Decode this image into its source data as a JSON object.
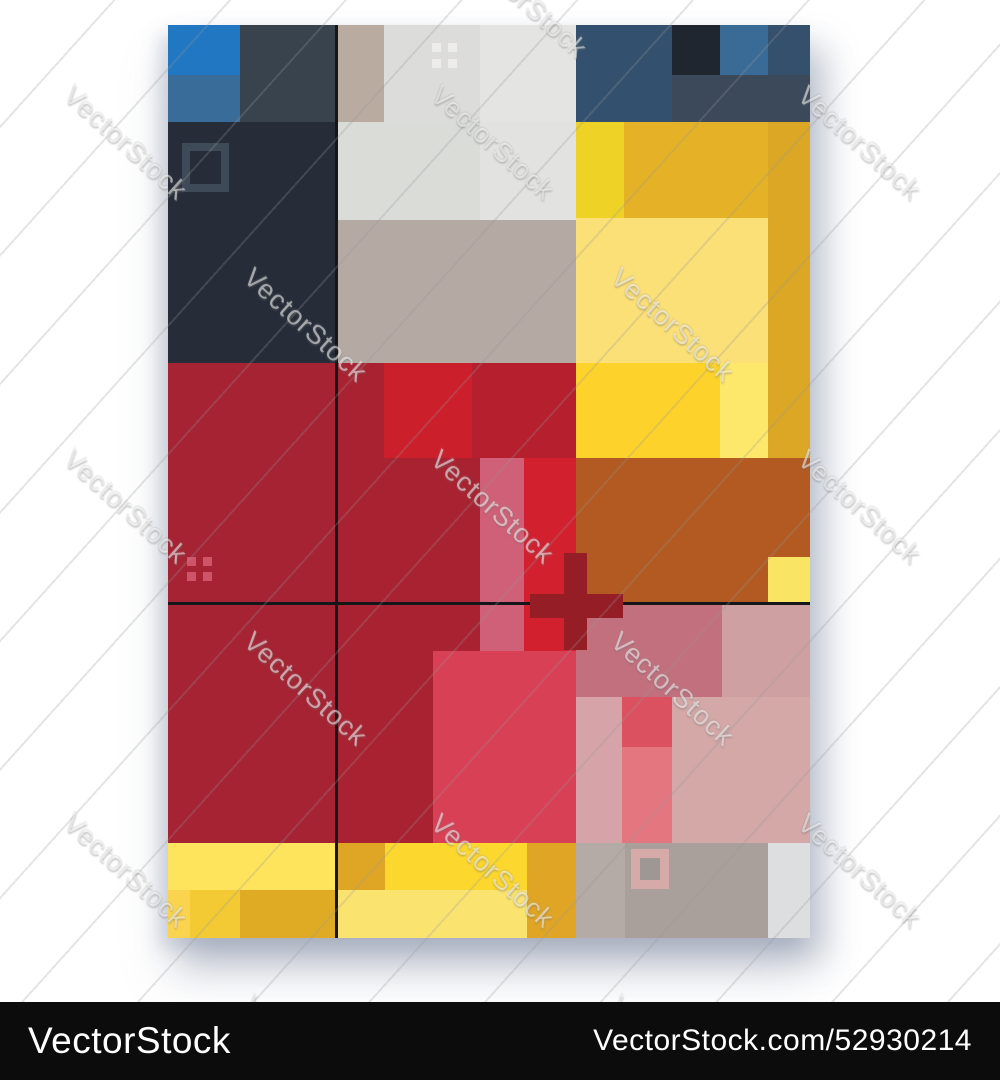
{
  "watermark": {
    "text": "VectorStock",
    "angle_deg": 42,
    "tiles": [
      {
        "x": 478,
        "y": -62
      },
      {
        "x": 78,
        "y": 80
      },
      {
        "x": 445,
        "y": 80
      },
      {
        "x": 812,
        "y": 80
      },
      {
        "x": 258,
        "y": 262
      },
      {
        "x": 625,
        "y": 262
      },
      {
        "x": 78,
        "y": 444
      },
      {
        "x": 445,
        "y": 444
      },
      {
        "x": 812,
        "y": 444
      },
      {
        "x": 258,
        "y": 626
      },
      {
        "x": 625,
        "y": 626
      },
      {
        "x": 78,
        "y": 808
      },
      {
        "x": 445,
        "y": 808
      },
      {
        "x": 812,
        "y": 808
      },
      {
        "x": 258,
        "y": 990
      },
      {
        "x": 625,
        "y": 990
      }
    ]
  },
  "footer": {
    "left_text": "VectorStock",
    "right_text": "VectorStock.com/52930214",
    "background": "#0c0c0c",
    "text_color": "#ffffff"
  },
  "poster": {
    "x": 168,
    "y": 25,
    "w": 642,
    "h": 913,
    "blocks": [
      {
        "name": "top-left-slate",
        "x": 0,
        "y": 0,
        "w": 168,
        "h": 97,
        "color": "#39434e"
      },
      {
        "name": "top-left-blue-bright",
        "x": 0,
        "y": 0,
        "w": 72,
        "h": 50,
        "color": "#2277c2"
      },
      {
        "name": "top-left-blue-medium",
        "x": 0,
        "y": 50,
        "w": 72,
        "h": 47,
        "color": "#3a6c99"
      },
      {
        "name": "top-left-navy-dark",
        "x": 0,
        "y": 97,
        "w": 168,
        "h": 241,
        "color": "#262d39"
      },
      {
        "name": "square-frame-dark",
        "x": 14,
        "y": 118,
        "w": 47,
        "h": 49,
        "border_color": "#3f4a58",
        "border_width": 8
      },
      {
        "name": "top-mid-taupe",
        "x": 168,
        "y": 0,
        "w": 48,
        "h": 97,
        "color": "#b9ab9f"
      },
      {
        "name": "top-mid-gray-1",
        "x": 216,
        "y": 0,
        "w": 96,
        "h": 97,
        "color": "#dcdcda"
      },
      {
        "name": "top-mid-gray-2",
        "x": 312,
        "y": 0,
        "w": 96,
        "h": 97,
        "color": "#e4e4e3"
      },
      {
        "name": "top-mid-sage",
        "x": 168,
        "y": 97,
        "w": 144,
        "h": 98,
        "color": "#d9dcd7"
      },
      {
        "name": "top-mid-gray-3",
        "x": 312,
        "y": 97,
        "w": 96,
        "h": 98,
        "color": "#e2e2e1"
      },
      {
        "name": "top-mid-taupe-row",
        "x": 168,
        "y": 195,
        "w": 240,
        "h": 143,
        "color": "#b5a9a3"
      },
      {
        "name": "white-dot",
        "x": 264,
        "y": 18,
        "w": 9,
        "h": 9,
        "color": "#efedeb"
      },
      {
        "name": "white-dot",
        "x": 280,
        "y": 18,
        "w": 9,
        "h": 9,
        "color": "#efedeb"
      },
      {
        "name": "white-dot",
        "x": 264,
        "y": 34,
        "w": 9,
        "h": 9,
        "color": "#efedeb"
      },
      {
        "name": "white-dot",
        "x": 280,
        "y": 34,
        "w": 9,
        "h": 9,
        "color": "#efedeb"
      },
      {
        "name": "top-right-navy",
        "x": 408,
        "y": 0,
        "w": 234,
        "h": 97,
        "color": "#33516e"
      },
      {
        "name": "top-right-dark-square",
        "x": 504,
        "y": 0,
        "w": 48,
        "h": 50,
        "color": "#20262f"
      },
      {
        "name": "top-right-blue-square",
        "x": 552,
        "y": 0,
        "w": 48,
        "h": 50,
        "color": "#3a6b97"
      },
      {
        "name": "top-right-navy-corner",
        "x": 600,
        "y": 0,
        "w": 42,
        "h": 50,
        "color": "#35506d"
      },
      {
        "name": "top-right-slate-strip",
        "x": 504,
        "y": 50,
        "w": 138,
        "h": 47,
        "color": "#3b495b"
      },
      {
        "name": "tr-yellow-bright",
        "x": 408,
        "y": 97,
        "w": 48,
        "h": 96,
        "color": "#eed225"
      },
      {
        "name": "tr-amber",
        "x": 456,
        "y": 97,
        "w": 144,
        "h": 96,
        "color": "#e5b126"
      },
      {
        "name": "tr-amber-column",
        "x": 600,
        "y": 97,
        "w": 42,
        "h": 336,
        "color": "#dba724"
      },
      {
        "name": "tr-yellow-light",
        "x": 408,
        "y": 193,
        "w": 192,
        "h": 145,
        "color": "#fbdf77"
      },
      {
        "name": "tr-yellow-bright-2",
        "x": 408,
        "y": 338,
        "w": 144,
        "h": 95,
        "color": "#fcd22b"
      },
      {
        "name": "tr-yellow-pale",
        "x": 552,
        "y": 338,
        "w": 48,
        "h": 95,
        "color": "#fde86b"
      },
      {
        "name": "mid-left-red",
        "x": 0,
        "y": 338,
        "w": 168,
        "h": 239,
        "color": "#a52333"
      },
      {
        "name": "bottom-left-red",
        "x": 0,
        "y": 577,
        "w": 168,
        "h": 241,
        "color": "#a52333"
      },
      {
        "name": "mid-red-base",
        "x": 168,
        "y": 338,
        "w": 240,
        "h": 239,
        "color": "#a92231"
      },
      {
        "name": "bottom-mid-red",
        "x": 168,
        "y": 577,
        "w": 240,
        "h": 241,
        "color": "#a92231"
      },
      {
        "name": "red-dot",
        "x": 19,
        "y": 532,
        "w": 9,
        "h": 9,
        "color": "#d05468"
      },
      {
        "name": "red-dot",
        "x": 35,
        "y": 532,
        "w": 9,
        "h": 9,
        "color": "#d05468"
      },
      {
        "name": "red-dot",
        "x": 19,
        "y": 547,
        "w": 9,
        "h": 9,
        "color": "#d05468"
      },
      {
        "name": "red-dot",
        "x": 35,
        "y": 547,
        "w": 9,
        "h": 9,
        "color": "#d05468"
      },
      {
        "name": "mid-red-column",
        "x": 304,
        "y": 338,
        "w": 104,
        "h": 95,
        "color": "#b51f2e"
      },
      {
        "name": "mid-red-square",
        "x": 216,
        "y": 338,
        "w": 88,
        "h": 95,
        "color": "#cc1f2c"
      },
      {
        "name": "orange-block",
        "x": 406,
        "y": 433,
        "w": 236,
        "h": 144,
        "color": "#b25a21"
      },
      {
        "name": "pink-band",
        "x": 312,
        "y": 433,
        "w": 44,
        "h": 193,
        "color": "#cf6077"
      },
      {
        "name": "bright-red-column",
        "x": 356,
        "y": 433,
        "w": 52,
        "h": 193,
        "color": "#d2202f"
      },
      {
        "name": "yellow-square-right",
        "x": 600,
        "y": 532,
        "w": 42,
        "h": 45,
        "color": "#fae464"
      },
      {
        "name": "rose-block",
        "x": 265,
        "y": 626,
        "w": 143,
        "h": 192,
        "color": "#d84055"
      },
      {
        "name": "br-rose",
        "x": 408,
        "y": 577,
        "w": 146,
        "h": 95,
        "color": "#c2707e"
      },
      {
        "name": "br-dusty-light",
        "x": 554,
        "y": 577,
        "w": 88,
        "h": 95,
        "color": "#cfa0a2"
      },
      {
        "name": "br-pink-column",
        "x": 408,
        "y": 672,
        "w": 46,
        "h": 146,
        "color": "#d5a3a8"
      },
      {
        "name": "br-redrose-square",
        "x": 454,
        "y": 672,
        "w": 50,
        "h": 50,
        "color": "#dc5160"
      },
      {
        "name": "br-salmon-column",
        "x": 454,
        "y": 722,
        "w": 50,
        "h": 96,
        "color": "#e4767f"
      },
      {
        "name": "br-dusty-pink",
        "x": 504,
        "y": 672,
        "w": 138,
        "h": 146,
        "color": "#d3a8a7"
      },
      {
        "name": "bl-yellow-strip",
        "x": 0,
        "y": 818,
        "w": 168,
        "h": 47,
        "color": "#fde45c"
      },
      {
        "name": "bl-yellow-1",
        "x": 0,
        "y": 865,
        "w": 22,
        "h": 48,
        "color": "#fbd44f"
      },
      {
        "name": "bl-yellow-2",
        "x": 22,
        "y": 865,
        "w": 50,
        "h": 48,
        "color": "#f3ca33"
      },
      {
        "name": "bl-amber",
        "x": 72,
        "y": 865,
        "w": 96,
        "h": 48,
        "color": "#e0ab24"
      },
      {
        "name": "bm-amber-square",
        "x": 168,
        "y": 818,
        "w": 49,
        "h": 47,
        "color": "#dfa626"
      },
      {
        "name": "bm-yellow-bright",
        "x": 217,
        "y": 818,
        "w": 142,
        "h": 47,
        "color": "#fcd72e"
      },
      {
        "name": "bm-amber-column",
        "x": 359,
        "y": 818,
        "w": 49,
        "h": 95,
        "color": "#e0a524"
      },
      {
        "name": "bm-yellow-light",
        "x": 168,
        "y": 865,
        "w": 191,
        "h": 48,
        "color": "#fbe370"
      },
      {
        "name": "br-gray-1",
        "x": 408,
        "y": 818,
        "w": 49,
        "h": 95,
        "color": "#b4aaa6"
      },
      {
        "name": "br-gray-2",
        "x": 457,
        "y": 818,
        "w": 143,
        "h": 95,
        "color": "#a9a09c"
      },
      {
        "name": "br-gray-light",
        "x": 600,
        "y": 818,
        "w": 42,
        "h": 95,
        "color": "#dcdee0"
      },
      {
        "name": "square-frame-pink",
        "x": 463,
        "y": 824,
        "w": 38,
        "h": 40,
        "border_color": "#d7aaaa",
        "border_width": 9,
        "fill": "#9e9793"
      },
      {
        "name": "grid-line-vertical",
        "x": 167,
        "y": 0,
        "w": 3,
        "h": 913,
        "color": "#15161a"
      },
      {
        "name": "grid-line-horizontal",
        "x": 0,
        "y": 577,
        "w": 642,
        "h": 3,
        "color": "#15161a"
      },
      {
        "name": "cross-horizontal",
        "x": 362,
        "y": 569,
        "w": 93,
        "h": 24,
        "color": "#951d26"
      },
      {
        "name": "cross-vertical",
        "x": 396,
        "y": 528,
        "w": 23,
        "h": 97,
        "color": "#951d26"
      }
    ]
  }
}
